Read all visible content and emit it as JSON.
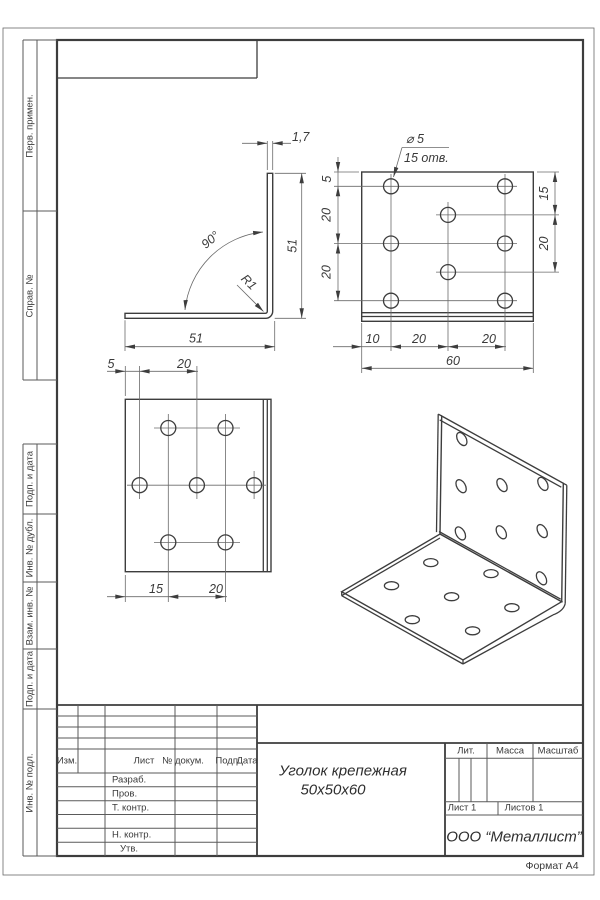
{
  "drawing": {
    "format_label": "Формат А4",
    "margin_labels": [
      "Перв. примен.",
      "Справ. №",
      "Подп. и дата",
      "Инв. № дубл.",
      "Взам. инв. №",
      "Подп. и дата",
      "Инв. № подл."
    ],
    "title_block": {
      "header_cols": [
        "Изм.",
        "Лист",
        "№ докум.",
        "Подп.",
        "Дата"
      ],
      "row_labels": [
        "Разраб.",
        "Пров.",
        "Т. контр.",
        "Н. контр.",
        "Утв."
      ],
      "title_line1": "Уголок крепежная",
      "title_line2": "50х50х60",
      "lit_label": "Лит.",
      "mass_label": "Масса",
      "scale_label": "Масштаб",
      "sheet_label": "Лист 1",
      "sheets_label": "Листов 1",
      "company": "ООО “Металлист”"
    },
    "views": {
      "side": {
        "thickness": "1,7",
        "height": "51",
        "width": "51",
        "angle": "90°",
        "radius": "R1"
      },
      "plan": {
        "hole_dia": "⌀ 5",
        "hole_count": "15 отв.",
        "left_dims": [
          "5",
          "20",
          "20"
        ],
        "right_dims": [
          "15",
          "20"
        ],
        "bottom_dims": [
          "10",
          "20",
          "20"
        ],
        "total_width": "60"
      },
      "front": {
        "top_dims": [
          "5",
          "20"
        ],
        "bottom_dims": [
          "15",
          "20"
        ]
      }
    }
  }
}
